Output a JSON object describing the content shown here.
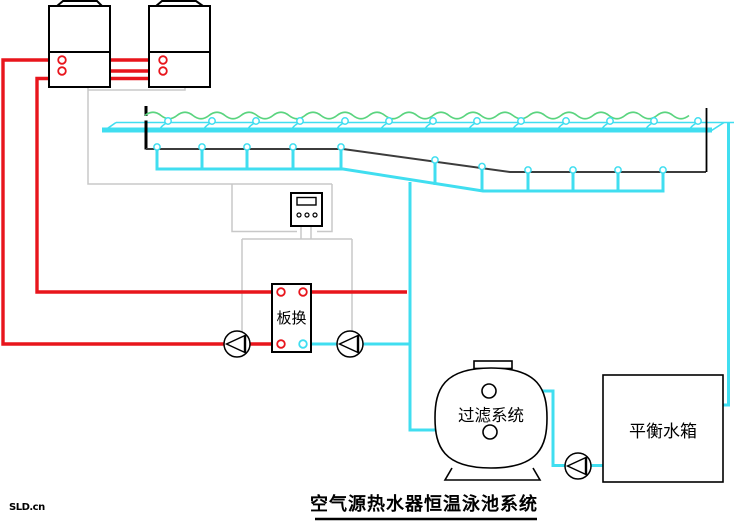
{
  "diagram": {
    "title": "空气源热水器恒温泳池系统",
    "watermark": "SLD.cn",
    "labels": {
      "heat_exchanger": "板换",
      "filter": "过滤系统",
      "balance_tank": "平衡水箱"
    },
    "colors": {
      "hot_water_pipe": "#e8151c",
      "pool_water_pipe": "#40def0",
      "water_surface": "#5ad47f",
      "control_wiring": "#c8c8c8",
      "pool_structure": "#3c3c3c",
      "equipment_outline": "#000000"
    },
    "counts": {
      "heat_pumps": 2,
      "circulation_pumps": 3,
      "pool_inlet_jets": 13,
      "pool_floor_drains": 11
    }
  }
}
